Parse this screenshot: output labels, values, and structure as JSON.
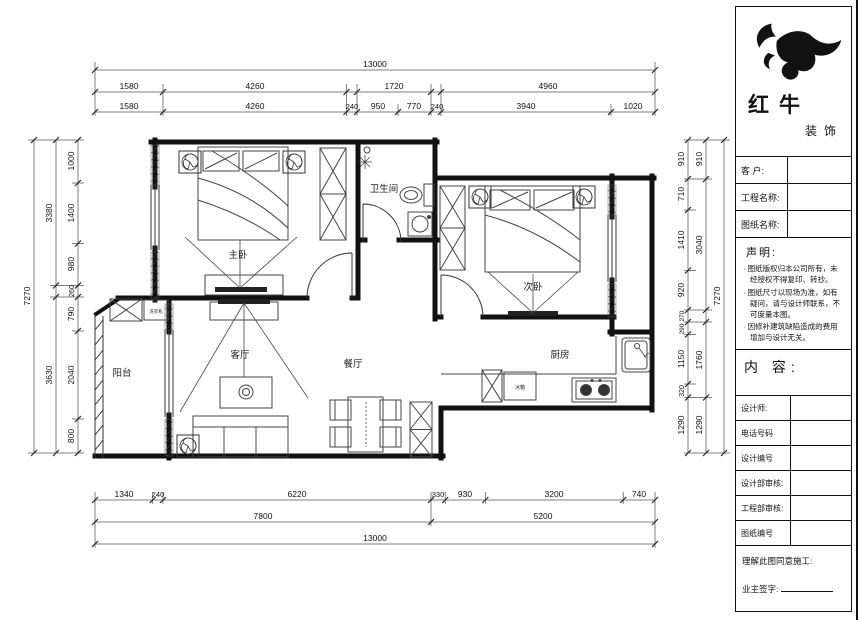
{
  "title_block": {
    "brand": {
      "name_main": "红牛",
      "name_sub": "装饰"
    },
    "fields": {
      "customer": "客 户:",
      "project": "工程名称:",
      "drawing": "图纸名称:"
    },
    "statement": {
      "heading": "声明:",
      "items": [
        "· 图纸版权归本公司所有，未经授权不得复印、转抄。",
        "· 图纸尺寸以现场为准，如有疑问，请与设计师联系，不可度量本图。",
        "· 因修补建筑缺陷造成的费用增加与设计无关。"
      ]
    },
    "content_label": "内 容:",
    "rows": [
      "设计师:",
      "电话号码",
      "设计编号",
      "设计部审核:",
      "工程部审核:",
      "图纸编号"
    ],
    "footer": {
      "line1": "理解此图同意施工:",
      "sign": "业主签字:"
    }
  },
  "rooms": {
    "master": "主卧",
    "bath": "卫生间",
    "second": "次卧",
    "living": "客厅",
    "dining": "餐厅",
    "kitchen": "厨房",
    "balcony": "阳台"
  },
  "appliances": {
    "fridge": "冰箱",
    "washer": "洗衣机"
  },
  "dimensions": {
    "top": {
      "total": "13000",
      "row2": [
        "1580",
        "4260",
        "1720",
        "4960"
      ],
      "row3": [
        "1580",
        "4260",
        "240",
        "950",
        "770",
        "240",
        "3940",
        "1020"
      ]
    },
    "bottom": {
      "row1": [
        "1340",
        "240",
        "6220",
        "330",
        "930",
        "3200",
        "740"
      ],
      "row2": [
        "7800",
        "5200"
      ],
      "total": "13000"
    },
    "left": {
      "outer": "7270",
      "mid": [
        "3380",
        "3630"
      ],
      "inner": [
        "1000",
        "1400",
        "980",
        "260",
        "790",
        "2040",
        "800"
      ]
    },
    "right": {
      "outer": "7270",
      "mid": [
        "910",
        "3040",
        "1760",
        "1290"
      ],
      "inner": [
        "910",
        "710",
        "1410",
        "920",
        "270",
        "290",
        "1150",
        "320",
        "1290"
      ]
    }
  }
}
